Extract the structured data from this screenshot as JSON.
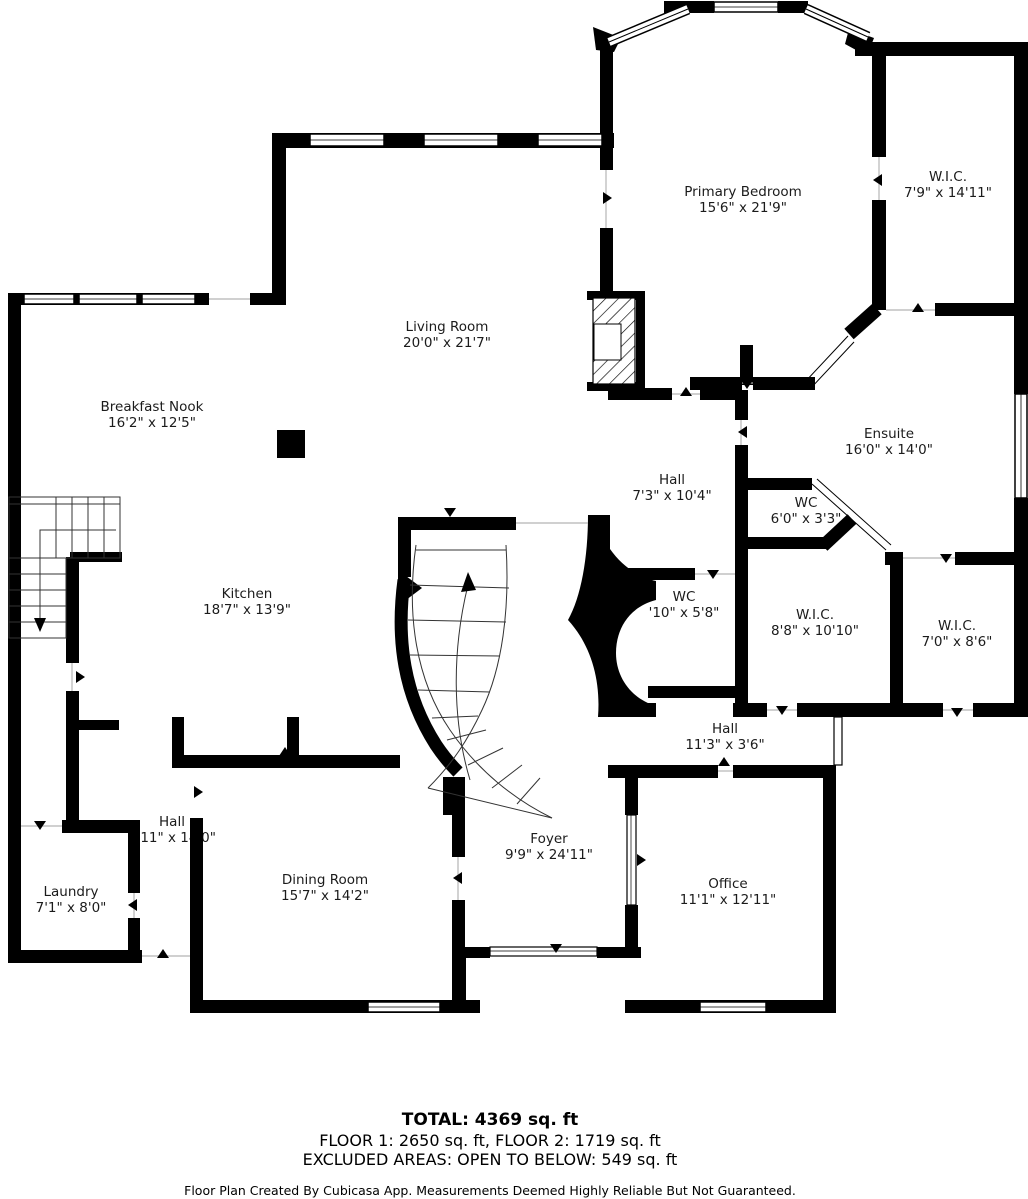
{
  "rooms": [
    {
      "name": "Primary Bedroom",
      "dims": "15'6\" x 21'9\""
    },
    {
      "name": "W.I.C.",
      "dims": "7'9\" x 14'11\""
    },
    {
      "name": "Living Room",
      "dims": "20'0\" x 21'7\""
    },
    {
      "name": "Breakfast Nook",
      "dims": "16'2\" x 12'5\""
    },
    {
      "name": "Ensuite",
      "dims": "16'0\" x 14'0\""
    },
    {
      "name": "Hall",
      "dims": "7'3\" x 10'4\""
    },
    {
      "name": "WC",
      "dims": "6'0\" x 3'3\""
    },
    {
      "name": "Kitchen",
      "dims": "18'7\" x 13'9\""
    },
    {
      "name": "WC",
      "dims": "'10\" x 5'8\""
    },
    {
      "name": "W.I.C.",
      "dims": "8'8\" x 10'10\""
    },
    {
      "name": "W.I.C.",
      "dims": "7'0\" x 8'6\""
    },
    {
      "name": "Hall",
      "dims": "11'3\" x 3'6\""
    },
    {
      "name": "Hall",
      "dims": "6'11\" x 14'0\""
    },
    {
      "name": "Laundry",
      "dims": "7'1\" x 8'0\""
    },
    {
      "name": "Dining Room",
      "dims": "15'7\" x 14'2\""
    },
    {
      "name": "Foyer",
      "dims": "9'9\" x 24'11\""
    },
    {
      "name": "Office",
      "dims": "11'1\" x 12'11\""
    }
  ],
  "footer": {
    "total": "TOTAL: 4369 sq. ft",
    "floors": "FLOOR 1: 2650 sq. ft, FLOOR 2: 1719 sq. ft",
    "excluded": "EXCLUDED AREAS: OPEN TO BELOW: 549 sq. ft",
    "disclaimer": "Floor Plan Created By Cubicasa App. Measurements Deemed Highly Reliable But Not Guaranteed."
  },
  "colors": {
    "wall": "#000000",
    "background": "#ffffff",
    "text": "#1b1b1b"
  }
}
